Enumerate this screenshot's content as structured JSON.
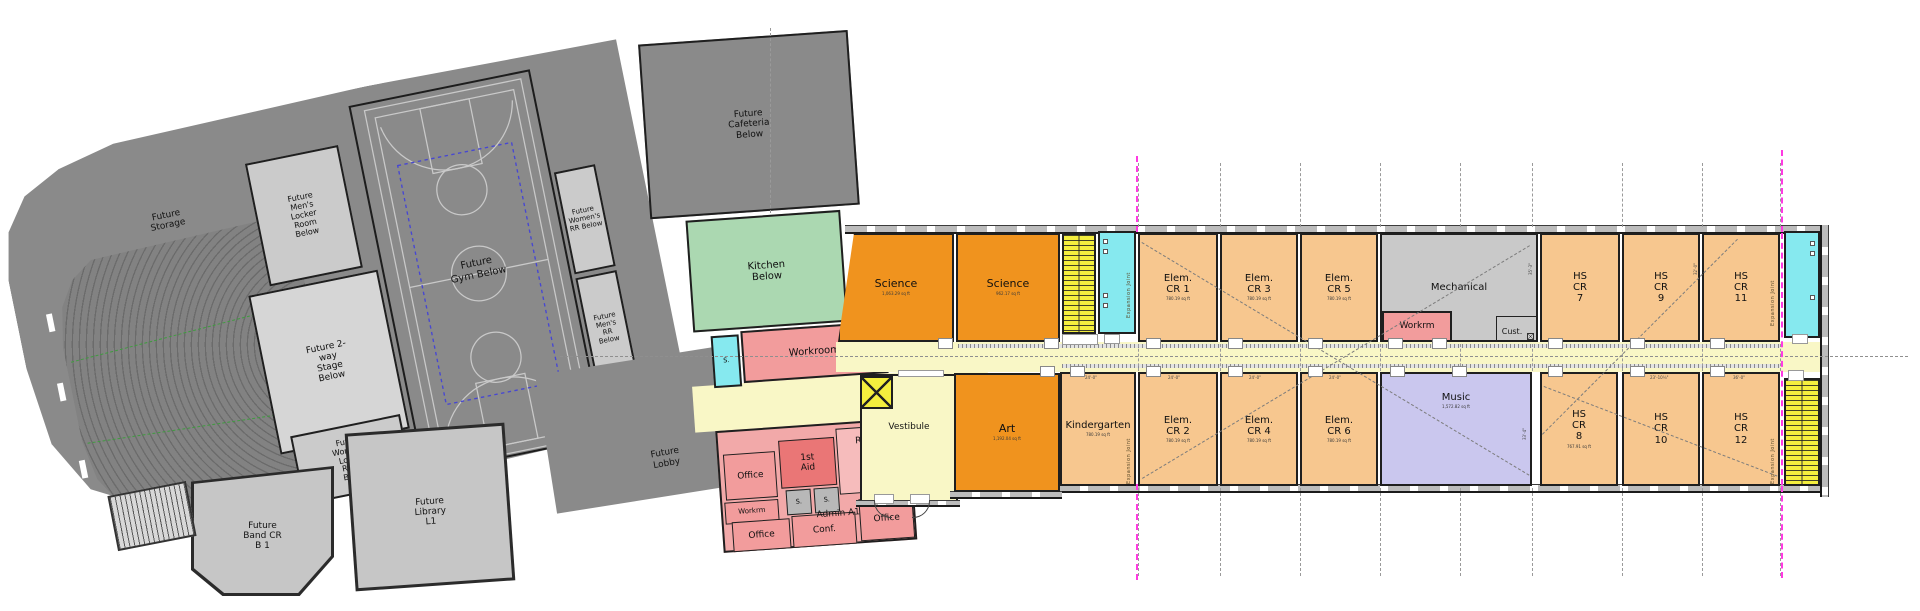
{
  "colors": {
    "future_gray": "#8a8a8a",
    "room_gray": "#cbcbcb",
    "stage_gray": "#d6d6d6",
    "mech_gray": "#c9c9c9",
    "kitchen_green": "#abd8b1",
    "pink": "#f29c9c",
    "pink_dark": "#ea7676",
    "pink_light": "#f6bcbc",
    "orange": "#f0931e",
    "orange_light": "#f7c78f",
    "lavender": "#cac7ee",
    "corridor_yellow": "#f9f7c6",
    "stair_yellow": "#f4ee3e",
    "restroom_cyan": "#86e9ef",
    "joint_magenta": "#ff3ae2",
    "wall": "#1f1f1f"
  },
  "left_wing": {
    "storage": "Future\nStorage",
    "mens_locker": "Future\nMen's\nLocker\nRoom\nBelow",
    "stage": "Future 2-\nway\nStage\nBelow",
    "womens_locker": "Future\nWomen's\nLocker\nRoom\nBelow",
    "gym": "Future\nGym Below",
    "womens_rr": "Future\nWomen's\nRR Below",
    "mens_rr": "Future\nMen's\nRR\nBelow",
    "band_cr": "Future\nBand CR\nB 1",
    "library": "Future\nLibrary\nL1",
    "lobby": "Future\nLobby"
  },
  "mid": {
    "cafeteria": "Future\nCafeteria\nBelow",
    "kitchen": "Kitchen\nBelow",
    "stor": "S.",
    "workroom": "Workroom",
    "office_nw": "Office",
    "first_aid": "1st\nAid",
    "reception": "Recept.",
    "toilet_a": "S.",
    "toilet_b": "S.",
    "workrm": "Workrm",
    "admin": "Admin A1",
    "office_sw": "Office",
    "conference": "Conf.",
    "office_se": "Office",
    "vestibule": "Vestibule"
  },
  "north_rooms": [
    {
      "label": "Science",
      "area": "1,063.29 sq ft"
    },
    {
      "label": "Science",
      "area": "962.17 sq ft"
    },
    {
      "label": "Elem.\nCR 1",
      "area": "780.19 sq ft"
    },
    {
      "label": "Elem.\nCR 3",
      "area": "780.19 sq ft"
    },
    {
      "label": "Elem.\nCR 5",
      "area": "780.19 sq ft"
    },
    {
      "label": "Mechanical"
    },
    {
      "label": "Workrm"
    },
    {
      "label": "Cust."
    },
    {
      "label": "HS\nCR\n7"
    },
    {
      "label": "HS\nCR\n9"
    },
    {
      "label": "HS\nCR\n11"
    }
  ],
  "south_rooms": [
    {
      "label": "Art",
      "area": "1,192.04 sq ft"
    },
    {
      "label": "Kindergarten",
      "area": "780.19 sq ft"
    },
    {
      "label": "Elem.\nCR 2",
      "area": "780.19 sq ft"
    },
    {
      "label": "Elem.\nCR 4",
      "area": "780.19 sq ft"
    },
    {
      "label": "Elem.\nCR 6",
      "area": "780.19 sq ft"
    },
    {
      "label": "Music",
      "area": "1,572.82 sq ft"
    },
    {
      "label": "HS\nCR\n8",
      "area": "767.91 sq ft"
    },
    {
      "label": "HS\nCR\n10"
    },
    {
      "label": "HS\nCR\n12"
    }
  ],
  "annotations": {
    "expansion_joint": "Expansion Joint",
    "dim_24": "24'-0\"",
    "dim_hs10": "23'-10¼\"",
    "dim_hs12": "36'-0\"",
    "dim_music": "33'-4\"",
    "dim_mech": "35'-3\"",
    "dim_hs9": "32'-0\""
  }
}
